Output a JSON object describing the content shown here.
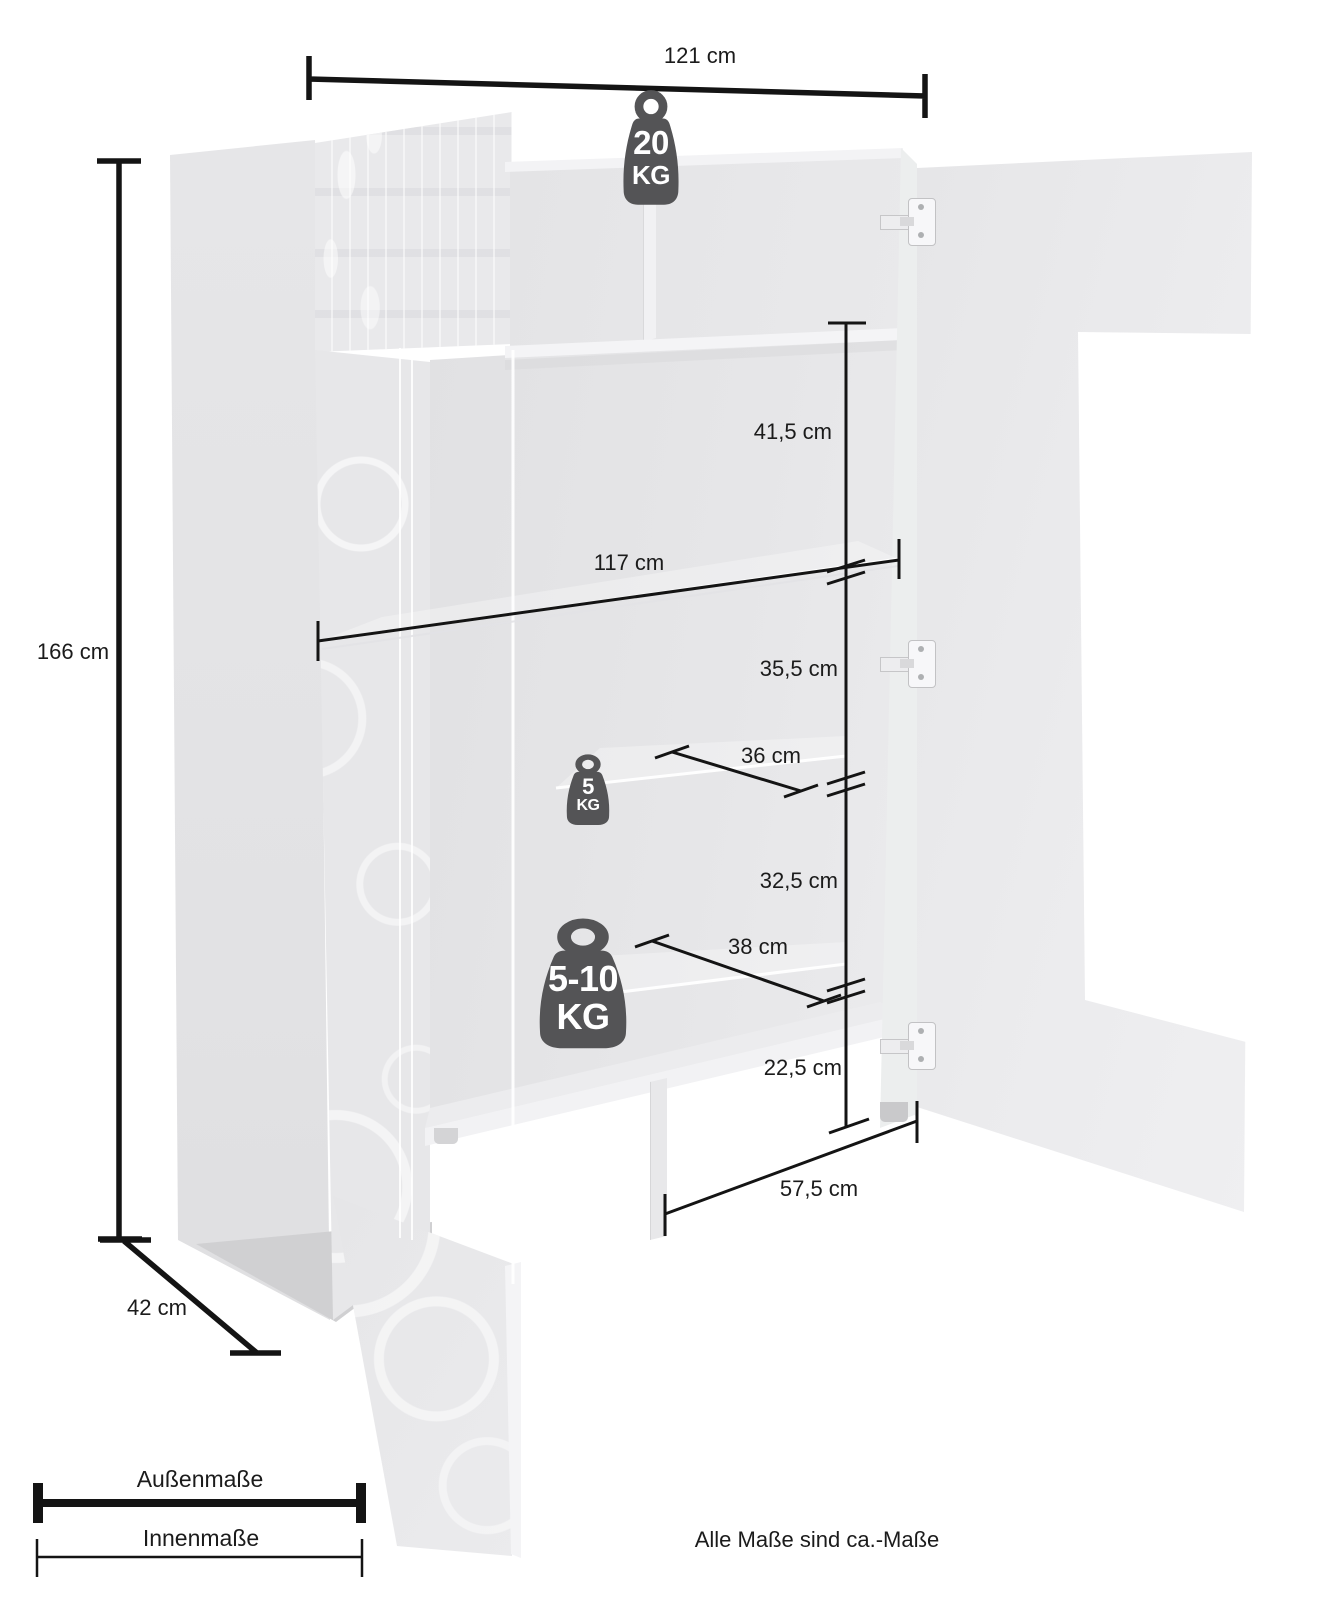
{
  "note": "Alle Maße sind ca.-Maße",
  "legend": {
    "outer_label": "Außenmaße",
    "inner_label": "Innenmaße"
  },
  "dimensions": {
    "outer_width": {
      "label": "121 cm"
    },
    "outer_height": {
      "label": "166 cm"
    },
    "outer_depth": {
      "label": "42 cm"
    },
    "inner_width": {
      "label": "117 cm"
    },
    "top_section_height": {
      "label": "41,5 cm"
    },
    "middle_section_height": {
      "label": "35,5 cm"
    },
    "glass_shelf_depth": {
      "label": "36 cm"
    },
    "lower_section_height": {
      "label": "32,5 cm"
    },
    "lower_shelf_depth": {
      "label": "38 cm"
    },
    "base_section_height": {
      "label": "22,5 cm"
    },
    "base_compartment_width": {
      "label": "57,5 cm"
    }
  },
  "load_capacity": {
    "top_panel": {
      "value": "20",
      "unit": "KG"
    },
    "glass_shelf": {
      "value": "5",
      "unit": "KG"
    },
    "wooden_shelf": {
      "value": "5-10",
      "unit": "KG"
    }
  },
  "colors": {
    "dimension_line": "#141414",
    "label_text": "#1b1b1b",
    "weight_icon": "#545456",
    "cabinet_light": "#e7e7e9",
    "background": "#ffffff"
  }
}
